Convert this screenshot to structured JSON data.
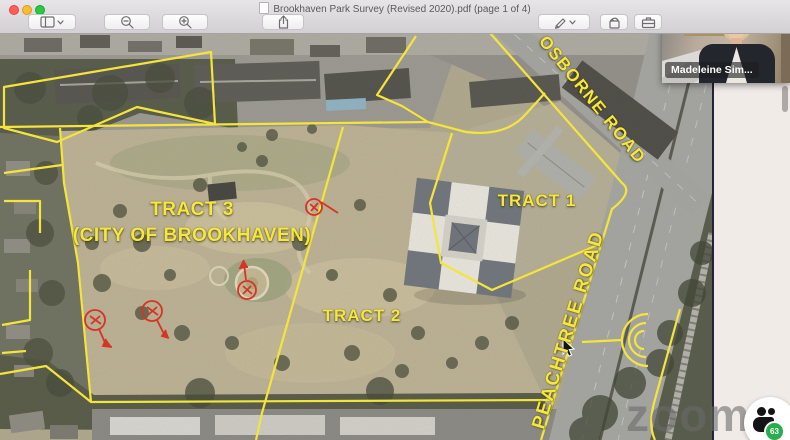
{
  "titlebar": {
    "title": "Brookhaven Park Survey (Revised 2020).pdf (page 1 of 4)"
  },
  "toolbar": {
    "buttons": [
      "sidebar-view",
      "zoom-out",
      "zoom-in",
      "share",
      "markup-pen",
      "rotate",
      "markup-toolbox"
    ]
  },
  "icons": {
    "close": "●",
    "minimize": "●",
    "fullscreen": "●",
    "sidebar_view": "◫",
    "chevron_down": "⌄",
    "zoom_out": "🔍−",
    "zoom_in": "🔍+",
    "share": "⤴",
    "markup_pen": "✎",
    "rotate": "↺",
    "markup_toolbox": "🧰",
    "document_proxy": "📄",
    "participant_silhouette": "👤",
    "mouse_cursor": "➤"
  },
  "map": {
    "labels": {
      "tract1": "TRACT 1",
      "tract2": "TRACT 2",
      "tract3_line1": "TRACT 3",
      "tract3_line2": "(CITY OF BROOKHAVEN)",
      "osborne_road": "OSBORNE ROAD",
      "peachtree_road": "PEACHTREE ROAD"
    },
    "survey_line_color": "#f4e53c",
    "annotation_color": "#d63426"
  },
  "video_overlay": {
    "participant_name": "Madeleine Sim..."
  },
  "watermark": {
    "text": "zoom"
  },
  "viewer_badge": {
    "count": "63"
  }
}
